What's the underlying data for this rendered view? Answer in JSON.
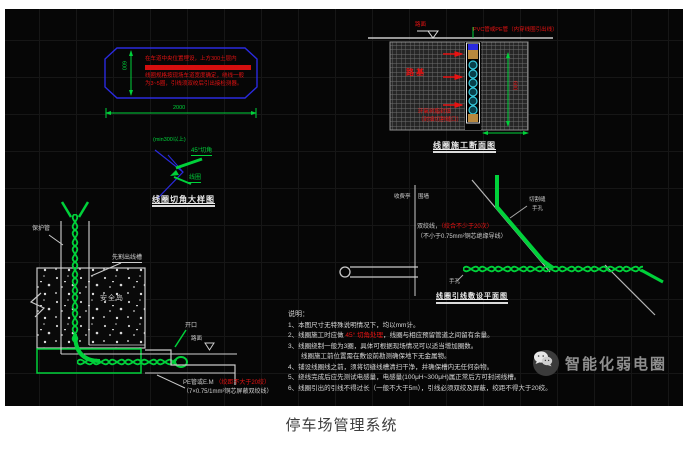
{
  "page": {
    "caption": "停车场管理系统"
  },
  "watermark": {
    "icon": "wechat-icon",
    "label": "智能化弱电圈"
  },
  "colors": {
    "line_green": "#00d13a",
    "line_blue": "#2a2ade",
    "line_red": "#e81313",
    "line_white": "#c9c9c9",
    "coil_cyan": "#35c8dc",
    "fill_tan": "#b9893e",
    "canvas_black": "#060606",
    "page_white": "#ffffff"
  },
  "coil_plan": {
    "dim_width": "2000",
    "dim_height": "600",
    "note_line1": "在车道中央位置埋设，上方300土层内",
    "note_line2": "不得有任何金属物，以免影响检测效果",
    "note_line3": "线圈规格按现场车道宽度确定，绕线一般",
    "note_line4": "为3~5圈，引线须双绞后引出接检测器。"
  },
  "corner_detail": {
    "label_min": "(min300以上)",
    "label_cut": "45°切角",
    "label_coil": "线圈",
    "title": "线圈切角大样图"
  },
  "section_view": {
    "label_level": "路面",
    "label_pipe": "PVC管或PE管（内穿线圈引出线）",
    "label_soil": "路基",
    "label_fill_line1": "环氧树脂封填",
    "label_fill_line2": "（封填切割缝口）",
    "dim_depth": "600",
    "title": "线圈施工断面图"
  },
  "plan_view": {
    "label_booth": "收费亭",
    "label_wall": "围墙",
    "label_cut": "切割缝",
    "label_handhole": "手孔",
    "wire_spec_pre": "双绞线，",
    "wire_spec_red": "（绞合不少于20次）",
    "wire_spec_line2": "（不小于0.75mm²铜芯绝缘导线）",
    "label_handhole2": "手孔",
    "title": "线圈引线敷设平面图"
  },
  "island_detail": {
    "label_conduit": "保护管",
    "label_slot": "先割出线槽",
    "label_island": "安全岛",
    "label_open": "开口",
    "label_road": "路面",
    "spec_pre": "PE管或E.M ",
    "spec_red": "（绞距不大于20绞）",
    "spec_line2": "（7×0.75/1mm²铜芯屏蔽双绞线）"
  },
  "notes": {
    "heading": "说明：",
    "line1": "1、本图尺寸无特殊说明情况下，均以mm计。",
    "line2_pre": "2、线圈施工时应做 ",
    "line2_red": "45° 切角处理",
    "line2_post": "，线圈与相应预留管道之间留有余量。",
    "line3": "3、线圈绕制一般为3圈，具体可根据现场情况可以适当增加圈数。",
    "line3b": "　　线圈施工前位置需在敷设前勘测确保地下无金属物。",
    "line4": "4、铺设线圈线之前，须将切缝线槽清扫干净，并确保槽内无任何杂物。",
    "line5": "5、绕线完成后应先测试电感量，电感量(100μH~300μH)属正常后方可封闭线槽。",
    "line6": "6、线圈引出的引线不得过长（一般不大于5m），引线必须双绞及屏蔽，绞距不得大于20绞。"
  }
}
